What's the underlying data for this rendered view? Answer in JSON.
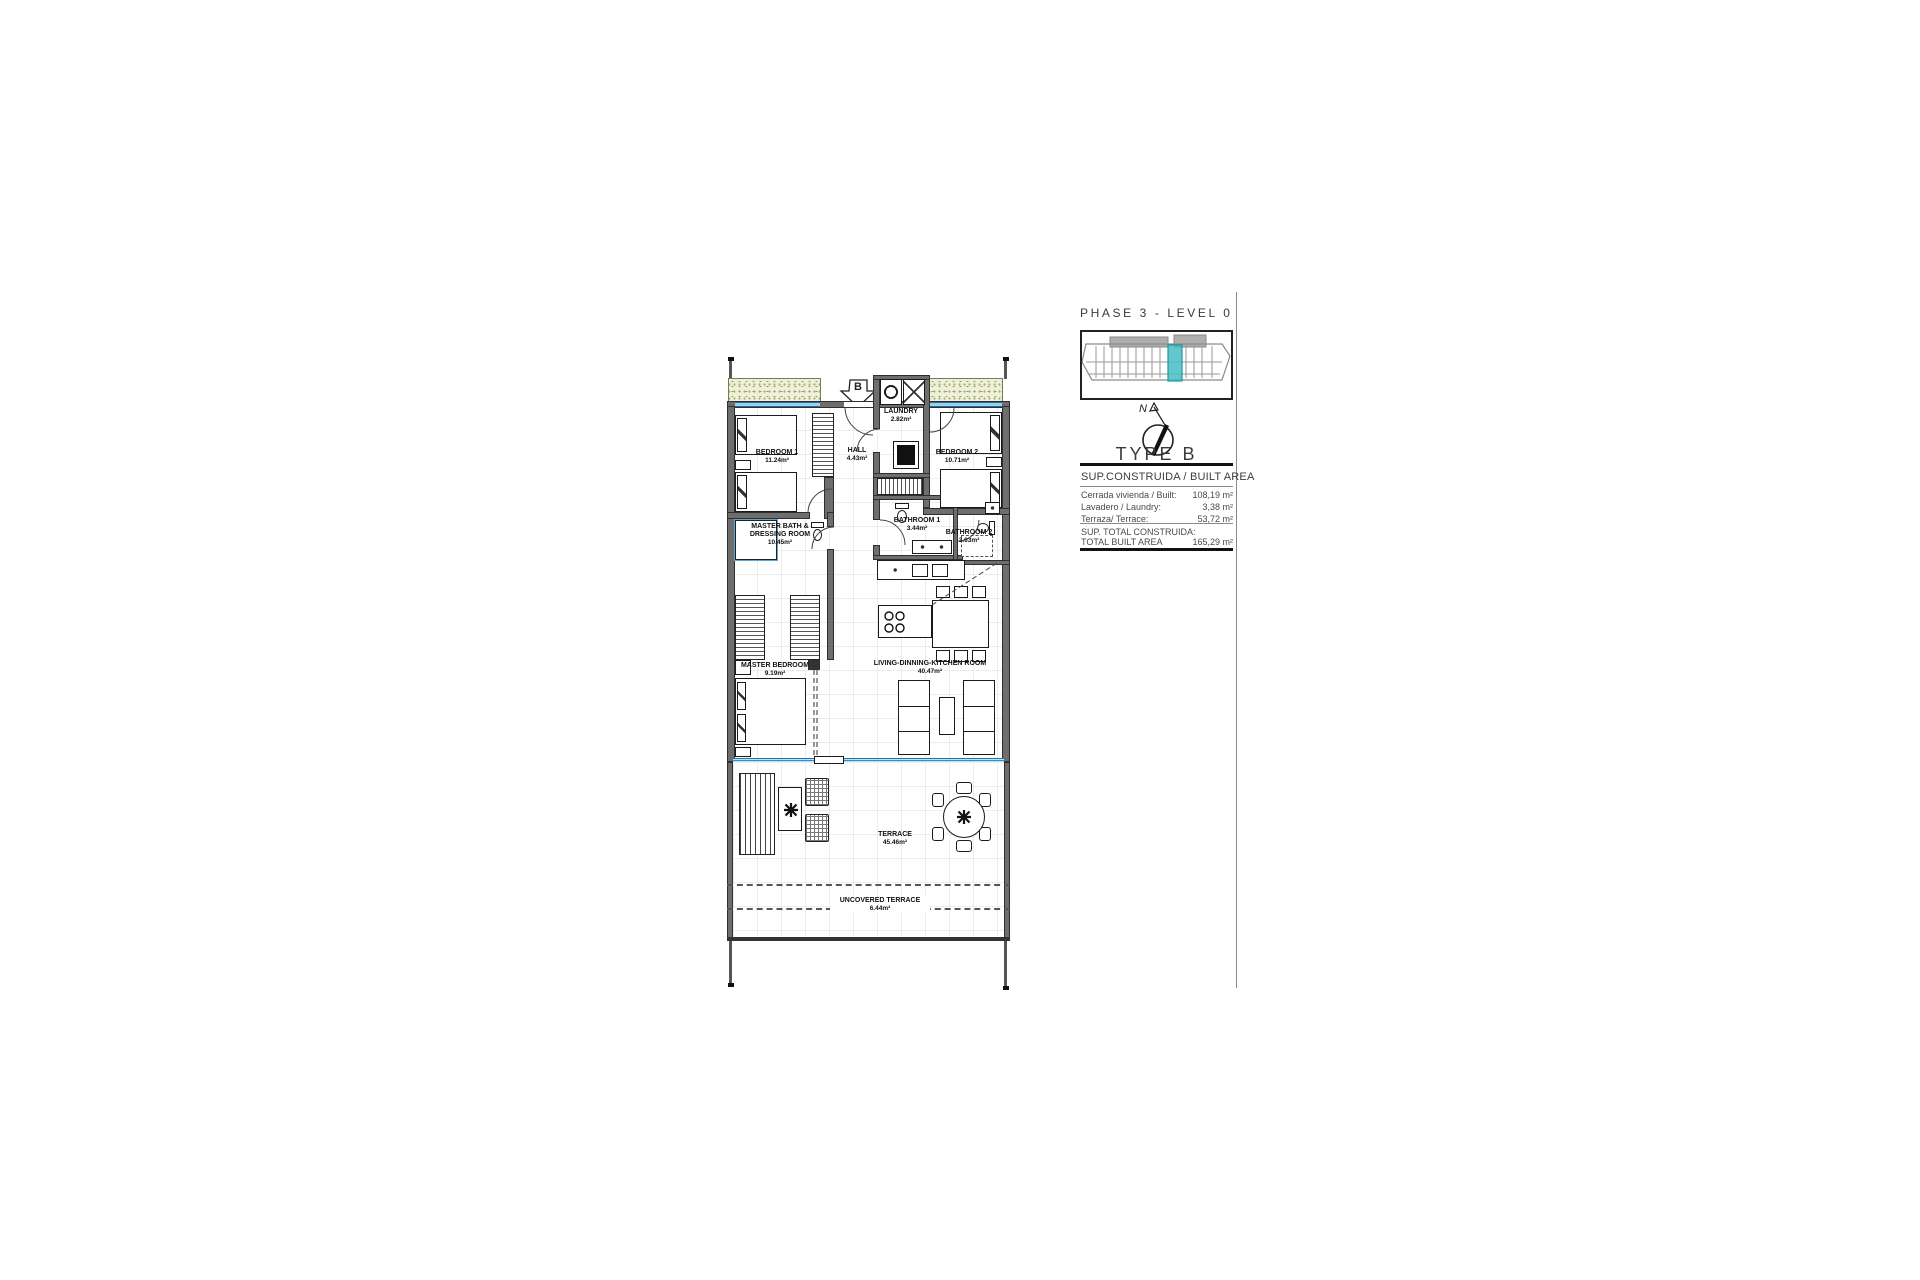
{
  "title_block": {
    "phase_title": "PHASE 3 - LEVEL 0",
    "type_title": "TYPE B",
    "area_header": "SUP.CONSTRUIDA / BUILT AREA",
    "rows": [
      {
        "label": "Cerrada vivienda / Built:",
        "value": "108,19 m²"
      },
      {
        "label": "Lavadero / Laundry:",
        "value": "3,38 m²"
      },
      {
        "label": "Terraza/ Terrace:",
        "value": "53,72 m²"
      }
    ],
    "total_label_line1": "SUP. TOTAL CONSTRUIDA:",
    "total_label_line2": "TOTAL BUILT AREA",
    "total_value": "165,29 m²",
    "north_label": "N"
  },
  "section_marker": {
    "label": "B"
  },
  "rooms": {
    "bedroom1": {
      "name": "BEDROOM 1",
      "area": "11.24m²"
    },
    "hall": {
      "name": "HALL",
      "area": "4.43m²"
    },
    "laundry": {
      "name": "LAUNDRY",
      "area": "2.82m²"
    },
    "bedroom2": {
      "name": "BEDROOM 2",
      "area": "10.71m²"
    },
    "bathroom1": {
      "name": "BATHROOM 1",
      "area": "3.44m²"
    },
    "bathroom2": {
      "name": "BATHROOM 2",
      "area": "3.63m²"
    },
    "master_bath": {
      "name_line1": "MASTER BATH &",
      "name_line2": "DRESSING ROOM",
      "area": "10.45m²"
    },
    "master_bedroom": {
      "name": "MASTER BEDROOM",
      "area": "9.19m²"
    },
    "living": {
      "name": "LIVING-DINNING-KITCHEN ROOM",
      "area": "40.47m²"
    },
    "terrace": {
      "name": "TERRACE",
      "area": "45.46m²"
    },
    "uncovered_terrace": {
      "name": "UNCOVERED TERRACE",
      "area": "6.44m²"
    }
  },
  "colors": {
    "wall": "#6e6e6e",
    "wall_dark": "#2f2f2f",
    "window_blue": "#2e8fc9",
    "glass_blue": "#9fd0ec",
    "highlight_teal": "#45bdc3",
    "planter_green": "#eef0dc",
    "planter_speck": "#8a9a50",
    "floor_grid": "#ececec",
    "ink": "#1a1a1a"
  }
}
